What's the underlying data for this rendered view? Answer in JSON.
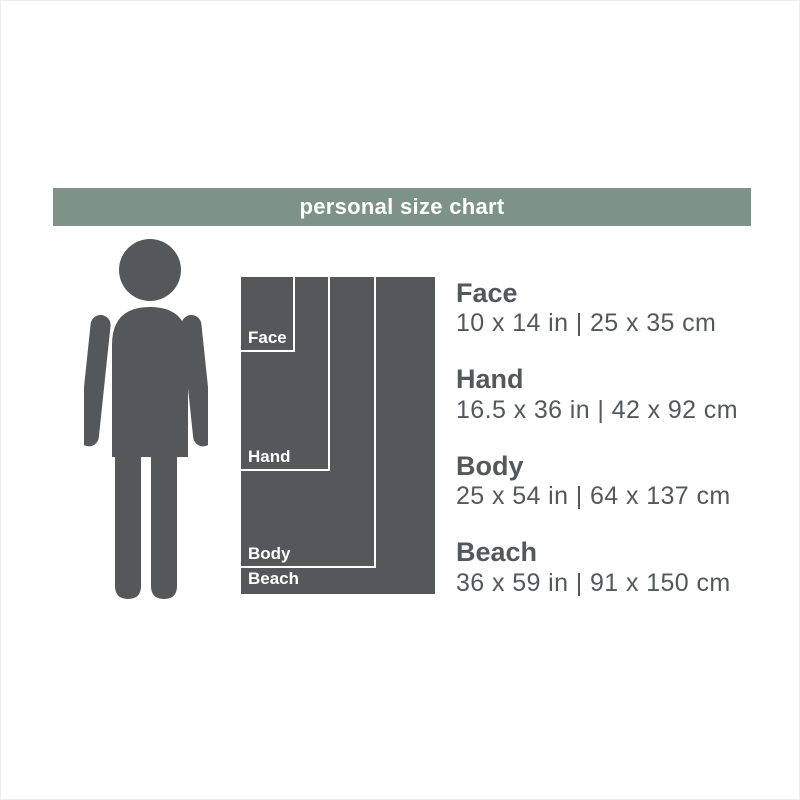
{
  "header": {
    "title": "personal size chart",
    "bg_color": "#7d9389",
    "text_color": "#ffffff"
  },
  "diagram": {
    "towel_color": "#54585b",
    "outline_color": "#ffffff",
    "person_color": "#54585b",
    "px_per_inch": 5.38
  },
  "sizes": [
    {
      "label": "Face",
      "width_in": 10,
      "height_in": 14,
      "inches": "10 x 14 in",
      "cm": "25 x 35 cm",
      "display": "10 x 14 in | 25 x 35 cm"
    },
    {
      "label": "Hand",
      "width_in": 16.5,
      "height_in": 36,
      "inches": "16.5 x 36 in",
      "cm": "42 x 92 cm",
      "display": "16.5 x 36 in | 42 x 92 cm"
    },
    {
      "label": "Body",
      "width_in": 25,
      "height_in": 54,
      "inches": "25 x 54 in",
      "cm": "64 x 137 cm",
      "display": "25 x 54 in | 64 x 137 cm"
    },
    {
      "label": "Beach",
      "width_in": 36,
      "height_in": 59,
      "inches": "36 x 59 in",
      "cm": "91 x 150 cm",
      "display": "36 x 59 in | 91 x 150 cm"
    }
  ]
}
